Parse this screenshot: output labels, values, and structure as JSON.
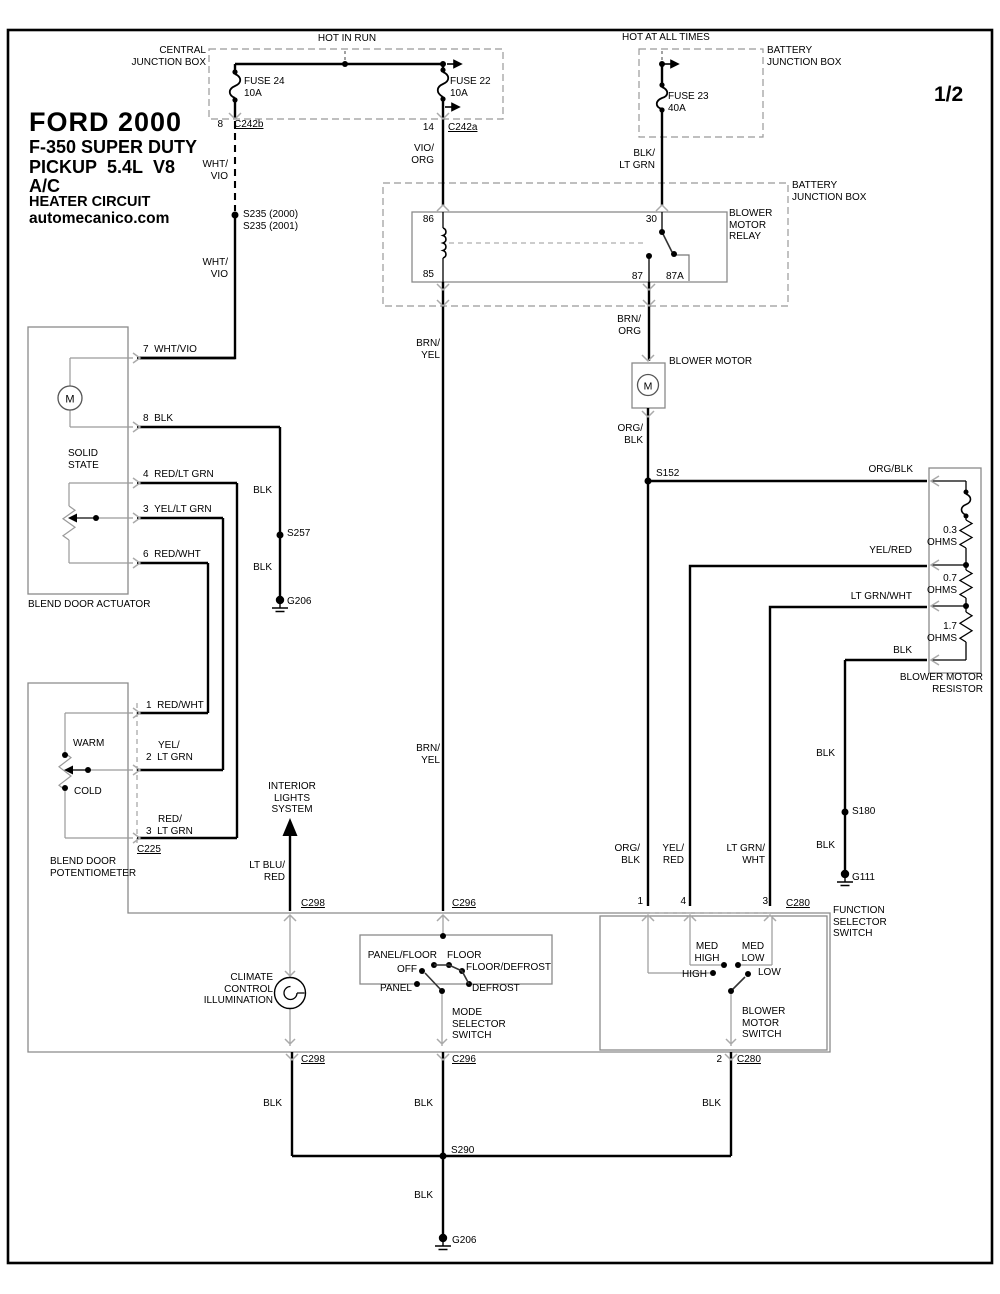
{
  "title": {
    "l1": "FORD 2000",
    "l2": "F-350 SUPER DUTY",
    "l3": "PICKUP  5.4L  V8",
    "l4": "A/C",
    "l5": "HEATER CIRCUIT",
    "l6": "automecanico.com"
  },
  "page": {
    "indicator": "1/2"
  },
  "power": {
    "hot_in_run": "HOT IN RUN",
    "hot_at_all_times": "HOT AT ALL TIMES",
    "central_jb": "CENTRAL\nJUNCTION BOX",
    "battery_jb_top": "BATTERY\nJUNCTION BOX",
    "battery_jb_relay": "BATTERY\nJUNCTION BOX",
    "fuse24": "FUSE 24\n10A",
    "fuse22": "FUSE 22\n10A",
    "fuse23": "FUSE 23\n40A"
  },
  "connectors": {
    "pin8": "8",
    "c242b": "C242b",
    "pin14": "14",
    "c242a": "C242a",
    "c225": "C225",
    "c298_top": "C298",
    "c296_top": "C296",
    "c280_top": "C280",
    "pin1": "1",
    "pin4": "4",
    "pin3": "3",
    "pin2": "2",
    "c298_bottom": "C298",
    "c296_bottom": "C296",
    "c280_bottom": "C280"
  },
  "relay": {
    "label": "BLOWER\nMOTOR\nRELAY",
    "pin86": "86",
    "pin85": "85",
    "pin30": "30",
    "pin87": "87",
    "pin87a": "87A"
  },
  "blower_motor": {
    "label": "BLOWER MOTOR",
    "m": "M"
  },
  "resistor": {
    "label": "BLOWER MOTOR\nRESISTOR",
    "r1": "0.3\nOHMS",
    "r2": "0.7\nOHMS",
    "r3": "1.7\nOHMS"
  },
  "actuator": {
    "label": "BLEND DOOR ACTUATOR",
    "solid_state": "SOLID\nSTATE",
    "m": "M",
    "pin7": "7  WHT/VIO",
    "pin8": "8  BLK",
    "pin4": "4  RED/LT GRN",
    "pin3": "3  YEL/LT GRN",
    "pin6": "6  RED/WHT"
  },
  "potentiometer": {
    "label": "BLEND DOOR\nPOTENTIOMETER",
    "warm": "WARM",
    "cold": "COLD",
    "pin1": "1  RED/WHT",
    "pin2_color": "YEL/",
    "pin2": "2  LT GRN",
    "pin3_color": "RED/",
    "pin3": "3  LT GRN"
  },
  "interior_lights": {
    "label": "INTERIOR\nLIGHTS\nSYSTEM"
  },
  "climate": {
    "label": "CLIMATE\nCONTROL\nILLUMINATION"
  },
  "mode_switch": {
    "label": "MODE\nSELECTOR\nSWITCH",
    "off": "OFF",
    "panel": "PANEL",
    "panel_floor": "PANEL/FLOOR",
    "floor": "FLOOR",
    "floor_defrost": "FLOOR/DEFROST",
    "defrost": "DEFROST"
  },
  "function_switch": {
    "label": "FUNCTION\nSELECTOR\nSWITCH",
    "blower_switch": "BLOWER\nMOTOR\nSWITCH",
    "high": "HIGH",
    "med_high": "MED\nHIGH",
    "med_low": "MED\nLOW",
    "low": "LOW"
  },
  "splices": {
    "s235": "S235 (2000)\nS235 (2001)",
    "s257": "S257",
    "s152": "S152",
    "s180": "S180",
    "s290": "S290"
  },
  "grounds": {
    "g206_left": "G206",
    "g111": "G111",
    "g206_bottom": "G206"
  },
  "wires": {
    "wht_vio_1": "WHT/\nVIO",
    "wht_vio_2": "WHT/\nVIO",
    "vio_org": "VIO/\nORG",
    "blk_lt_grn": "BLK/\nLT GRN",
    "brn_yel_1": "BRN/\nYEL",
    "brn_yel_2": "BRN/\nYEL",
    "brn_org": "BRN/\nORG",
    "org_blk_v1": "ORG/\nBLK",
    "org_blk_v2": "ORG/\nBLK",
    "org_blk_h": "ORG/BLK",
    "yel_red_h": "YEL/RED",
    "lt_grn_wht_h": "LT GRN/WHT",
    "yel_red_v": "YEL/\nRED",
    "lt_grn_wht_v": "LT GRN/\nWHT",
    "lt_blu_red": "LT BLU/\nRED",
    "blk_r": "BLK",
    "blk_s180_a": "BLK",
    "blk_s180_b": "BLK",
    "blk_act_a": "BLK",
    "blk_act_b": "BLK",
    "blk_c298": "BLK",
    "blk_c296": "BLK",
    "blk_c280": "BLK",
    "blk_g206": "BLK"
  }
}
